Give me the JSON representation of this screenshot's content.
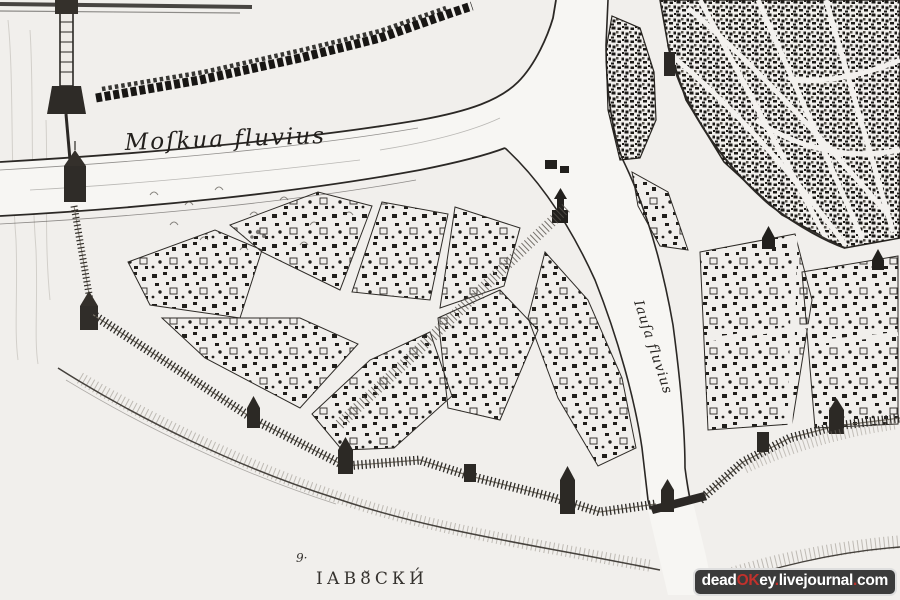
{
  "colors": {
    "paper": "#f1efec",
    "ink": "#23201d",
    "watermark_background": "#3b3b3b",
    "watermark_red": "#c2312c",
    "watermark_white": "#ffffff"
  },
  "labels": {
    "main_river": "Moſkua fluvius",
    "side_river": "Iauſa fluvius",
    "district": "ІАВ8̌СКИ́",
    "district_marker": "9·"
  },
  "watermark": {
    "parts": [
      {
        "text": "dead"
      },
      {
        "text": "OK"
      },
      {
        "text": "ey"
      },
      {
        "text": "."
      },
      {
        "text": "livejournal"
      },
      {
        "text": "."
      },
      {
        "text": "com"
      }
    ]
  }
}
